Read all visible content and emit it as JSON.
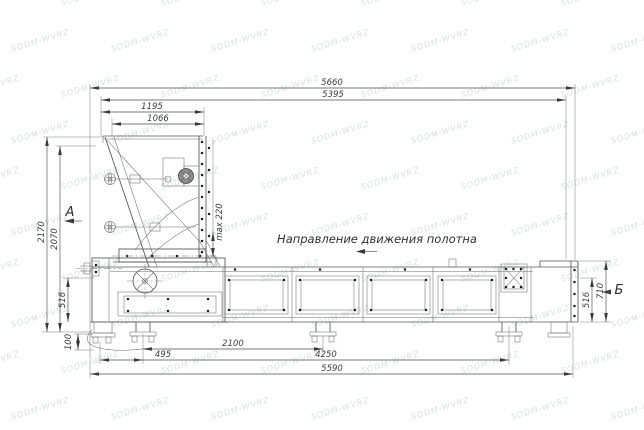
{
  "page": {
    "background": "#ffffff"
  },
  "watermark": {
    "text": "SODM-WVRZ"
  },
  "annotation": {
    "belt_direction": "Направление движения полотна"
  },
  "view_labels": {
    "a": "А",
    "b": "Б"
  },
  "dims": {
    "overall_length_top": "5660",
    "frame_length_top": "5395",
    "hopper_width_outer": "1195",
    "hopper_width_inner": "1066",
    "overall_height": "2170",
    "frame_height": "2070",
    "body_height_left": "516",
    "foot_height": "100",
    "support_offset": "495",
    "support_spacing": "2100",
    "support_span": "4250",
    "overall_length_bottom": "5590",
    "body_height_right": "516",
    "discharge_height": "710",
    "belt_clearance": "max 220"
  },
  "colors": {
    "line": "#565656",
    "dim_text": "#3c3c3c",
    "watermark_tint": "#8ca0af"
  }
}
